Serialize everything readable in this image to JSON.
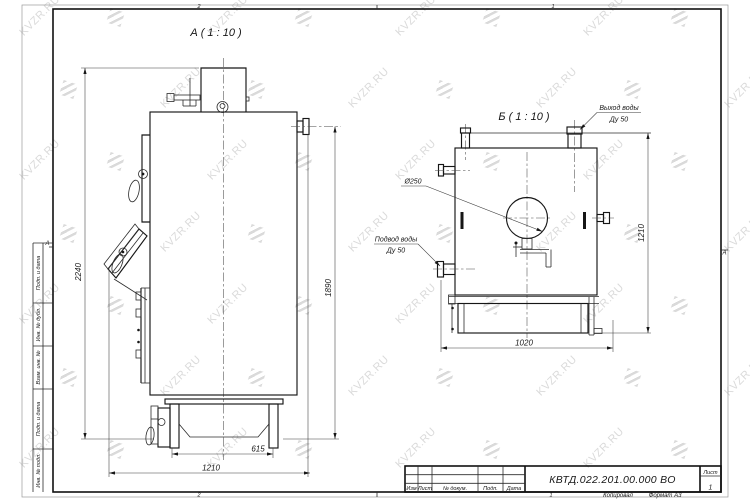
{
  "sheet": {
    "zones": {
      "top": [
        "2",
        "1"
      ],
      "bottom": [
        "2",
        "1"
      ],
      "left": "А",
      "right": "А"
    },
    "side_columns": [
      "Подп. и дата",
      "Инв. № дубл.",
      "Взам. инв. №",
      "Подп. и дата",
      "Инв. № подл."
    ]
  },
  "title_block": {
    "doc_number": "КВТД.022.201.00.000 ВО",
    "columns": [
      "Изм",
      "Лист",
      "№ докум.",
      "Подп.",
      "Дата"
    ],
    "sheet_label": "Лист",
    "sheet_number": "1",
    "copied_label": "Копировал",
    "format_label": "Формат А3"
  },
  "views": {
    "a": {
      "title": "А ( 1 : 10 )",
      "dims": {
        "height_total": "2240",
        "height_body": "1890",
        "base_width": "615",
        "depth": "1210"
      }
    },
    "b": {
      "title": "Б ( 1 : 10 )",
      "dims": {
        "width": "1020",
        "height": "1210",
        "flue_diameter": "Ø250"
      },
      "labels": {
        "outlet_line1": "Выход воды",
        "outlet_line2": "Ду 50",
        "inlet_line1": "Подвод воды",
        "inlet_line2": "Ду 50"
      }
    }
  },
  "watermark": {
    "text": "KVZR.RU"
  }
}
